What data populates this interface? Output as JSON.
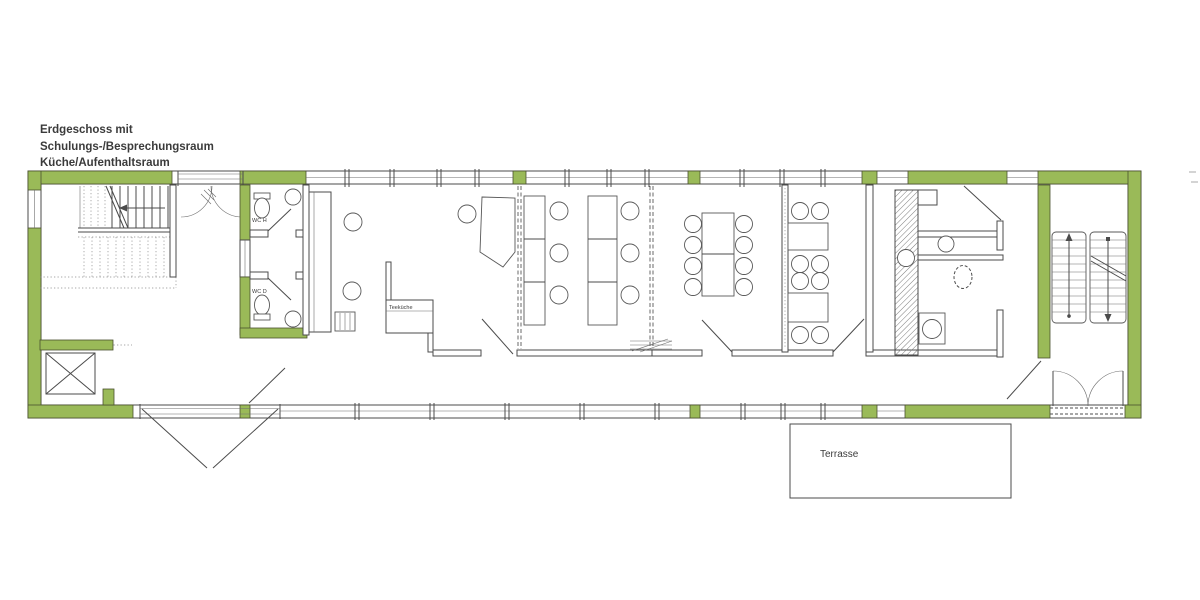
{
  "meta": {
    "description": "Architectural ground-floor plan, long rectangular building",
    "background_color": "#ffffff",
    "line_color": "#4b4b4b",
    "wall_highlight_green": "#9aba58"
  },
  "annotation": {
    "line1": "Erdgeschoss mit",
    "line2": "Schulungs-/Besprechungsraum",
    "line3": "Küche/Aufenthaltsraum"
  },
  "rooms": {
    "wc_men": "WC H",
    "wc_women": "WC D",
    "tea_kitchen": "Teeküche",
    "terrace": "Terrasse"
  }
}
